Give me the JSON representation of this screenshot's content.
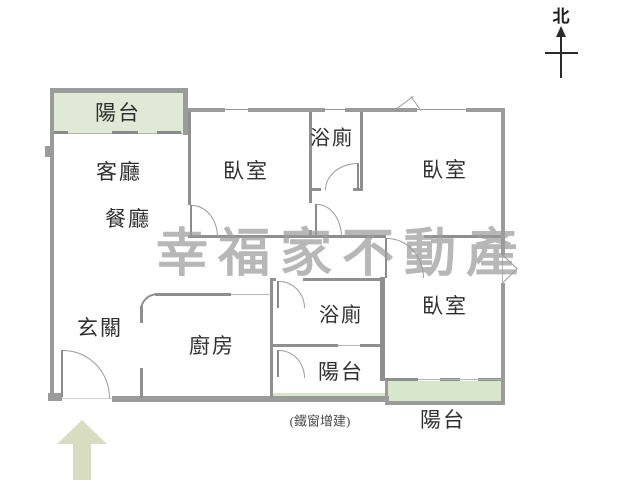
{
  "title": "apartment-floor-plan",
  "compass": {
    "label": "北"
  },
  "watermark": {
    "text": "幸福家不動產"
  },
  "annotation": {
    "text": "(鐵窗增建)"
  },
  "rooms": {
    "balcony_top": {
      "label": "陽台"
    },
    "living": {
      "label": "客廳"
    },
    "dining": {
      "label": "餐廳"
    },
    "bedroom_top_mid": {
      "label": "臥室"
    },
    "bath_top": {
      "label": "浴廁"
    },
    "bedroom_top_right": {
      "label": "臥室"
    },
    "entry": {
      "label": "玄關"
    },
    "kitchen": {
      "label": "廚房"
    },
    "bath_bottom": {
      "label": "浴廁"
    },
    "balcony_mid": {
      "label": "陽台"
    },
    "bedroom_bottom_right": {
      "label": "臥室"
    },
    "balcony_bottom": {
      "label": "陽台"
    }
  },
  "colors": {
    "wall": "#9b9b9b",
    "iwall": "#8f8f8f",
    "balcony_green": "#dfe9d6",
    "balcony_green2": "#d8e6cb",
    "arrow_green": "#d8dcc0",
    "watermark": "#9c9c9c",
    "label": "#2f2f2f"
  }
}
